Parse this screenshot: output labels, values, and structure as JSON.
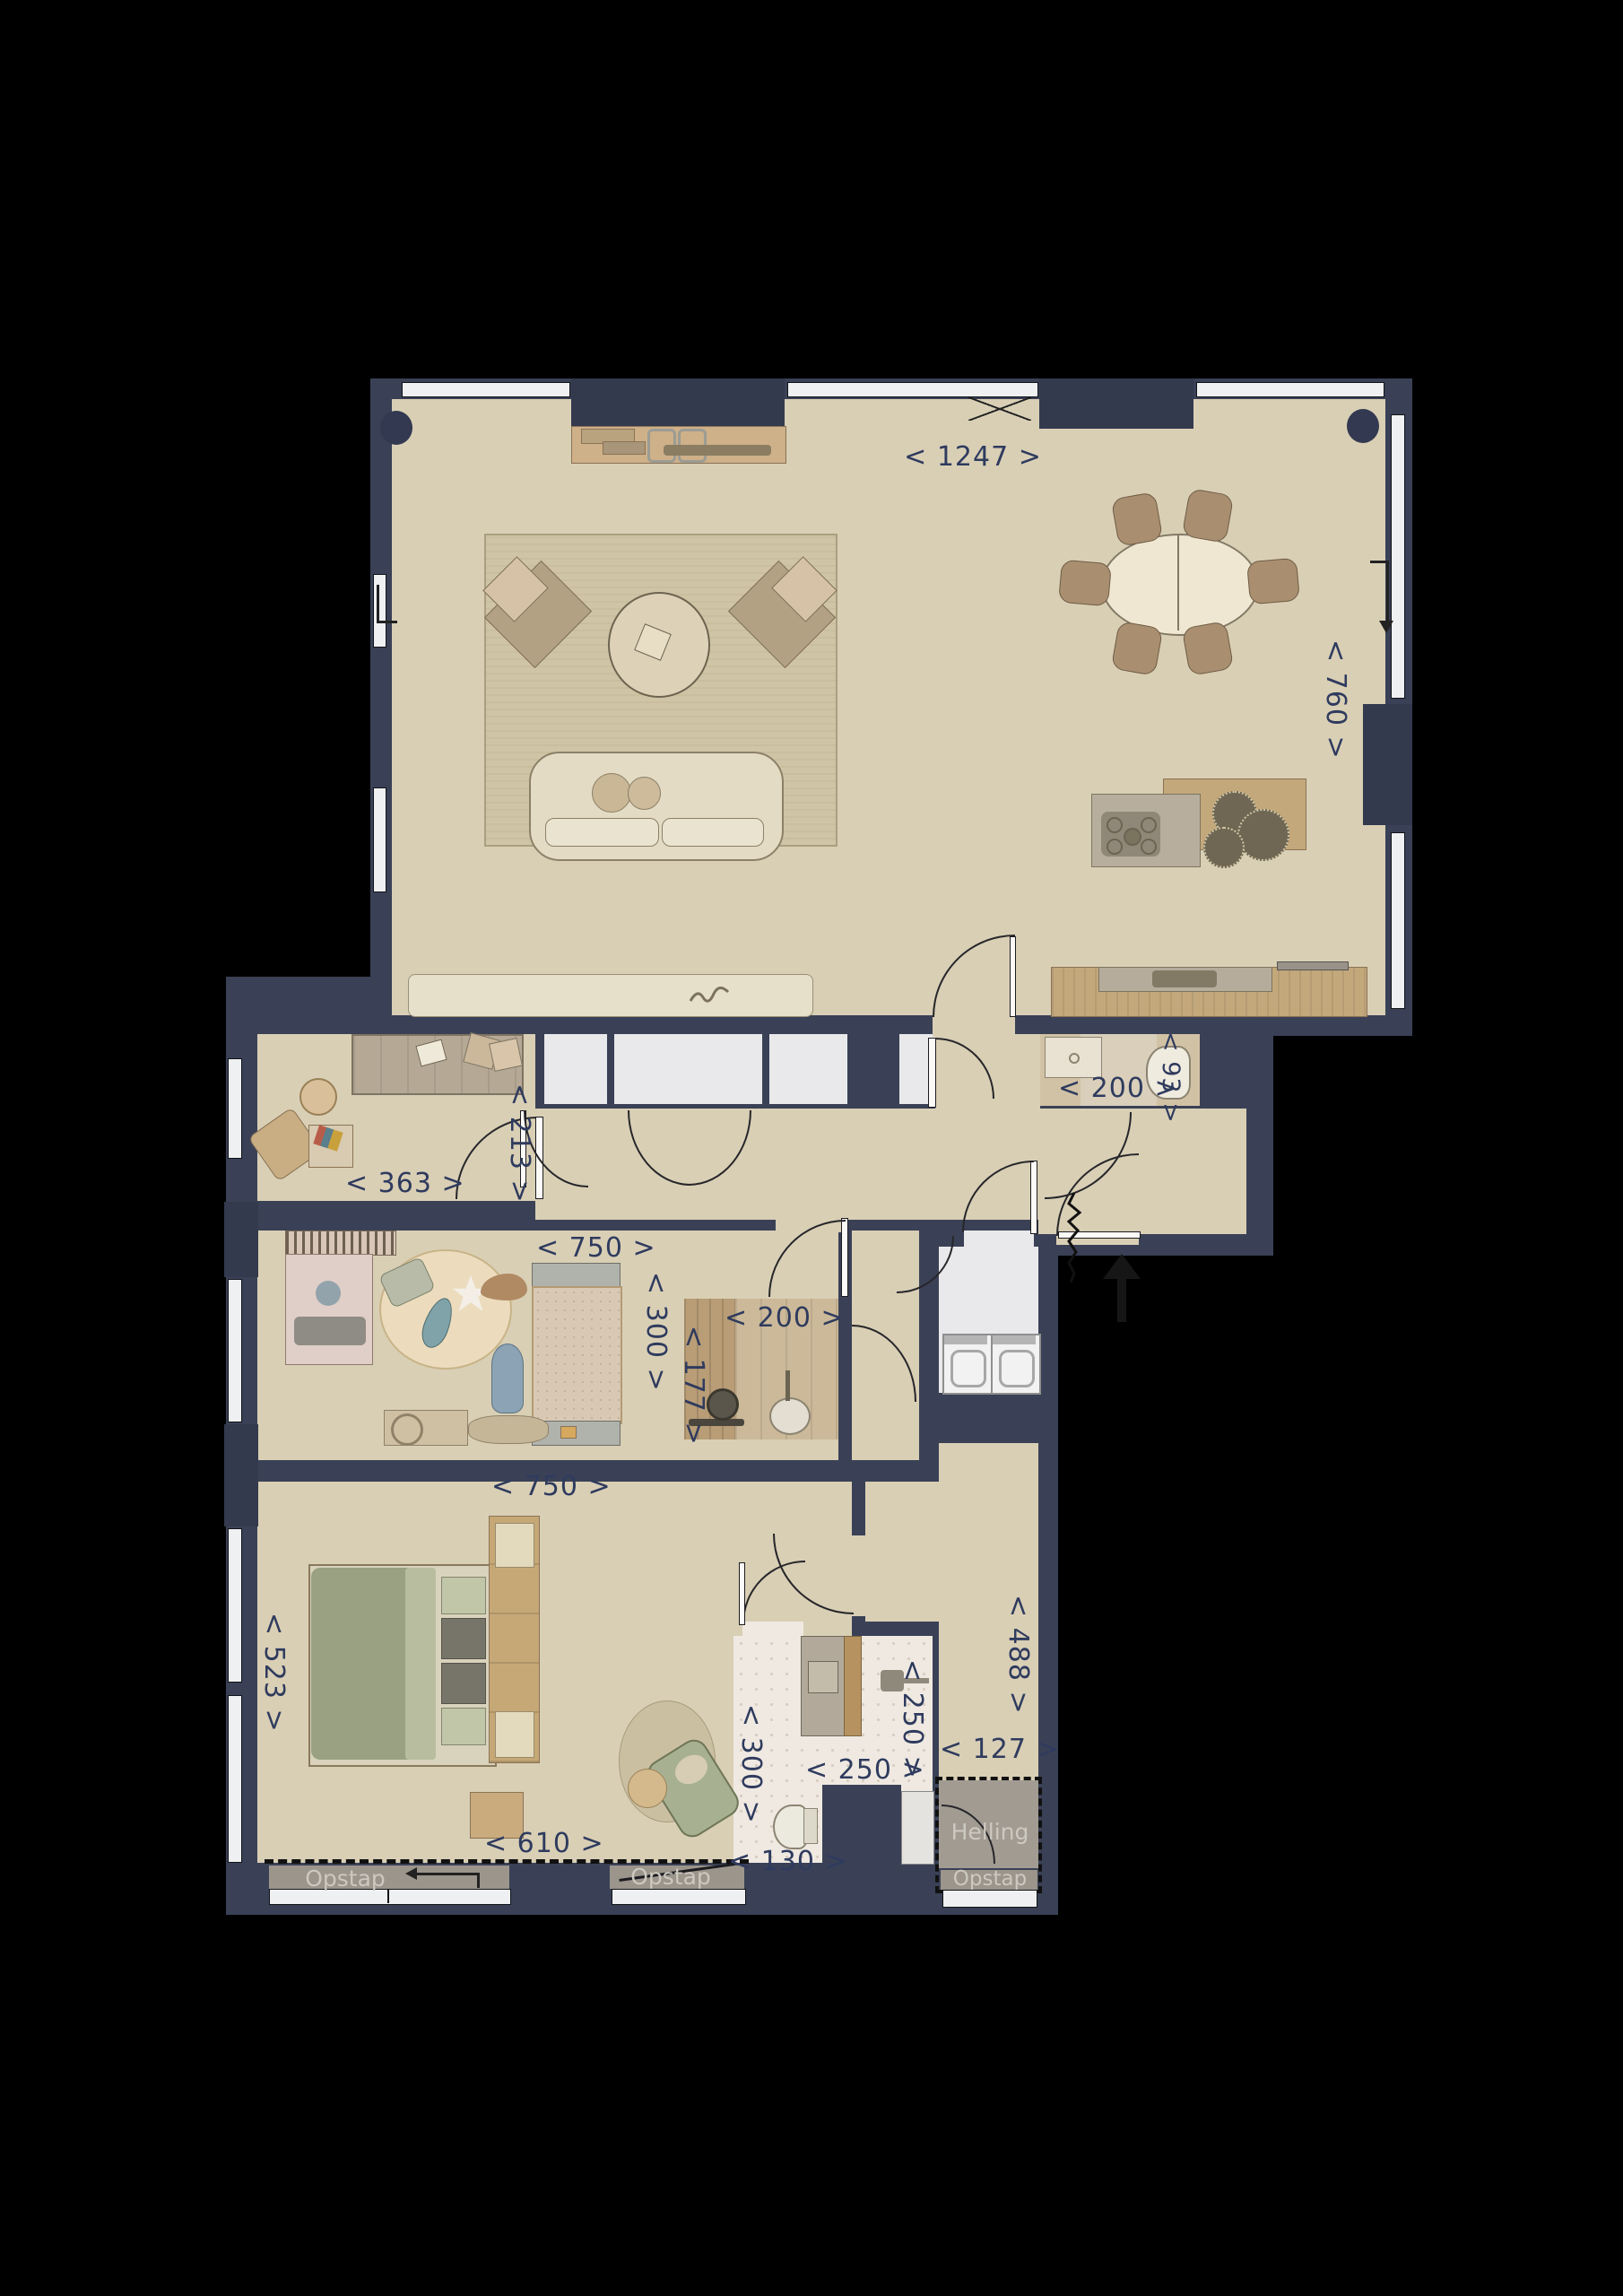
{
  "labels": {
    "living_width": "< 1247 >",
    "living_height": "< 760 >",
    "wc_width": "< 200 >",
    "wc_depth": "< 93 >",
    "study_width": "< 363 >",
    "study_depth": "< 213 >",
    "kids_width": "< 750 >",
    "kids_depth": "< 300 >",
    "storage_width": "< 200 >",
    "storage_depth": "< 177 >",
    "bedroom_width": "< 750 >",
    "bedroom_depth": "< 523 >",
    "bedroom_bottom_width": "< 610 >",
    "bath_left_width": "< 130 >",
    "bath_depth": "< 300 >",
    "bath_width": "< 250 >",
    "bath_right_depth": "< 250 >",
    "corridor_depth": "< 488 >",
    "corridor_width": "< 127 >",
    "ramp": "Helling",
    "step_left": "Opstap",
    "step_right": "Opstap",
    "step_ramp": "Opstap"
  },
  "colors": {
    "background": "#000000",
    "wall": "#3a4156",
    "floor": "#d9cfb5",
    "closet_floor": "#e9e9ec",
    "bath_floor": "#efe9e1",
    "dimension_text": "#2f3b5e",
    "step_text": "#ccc9c0",
    "wood": "#c3a87b",
    "ramp_fill": "#a29b92"
  }
}
